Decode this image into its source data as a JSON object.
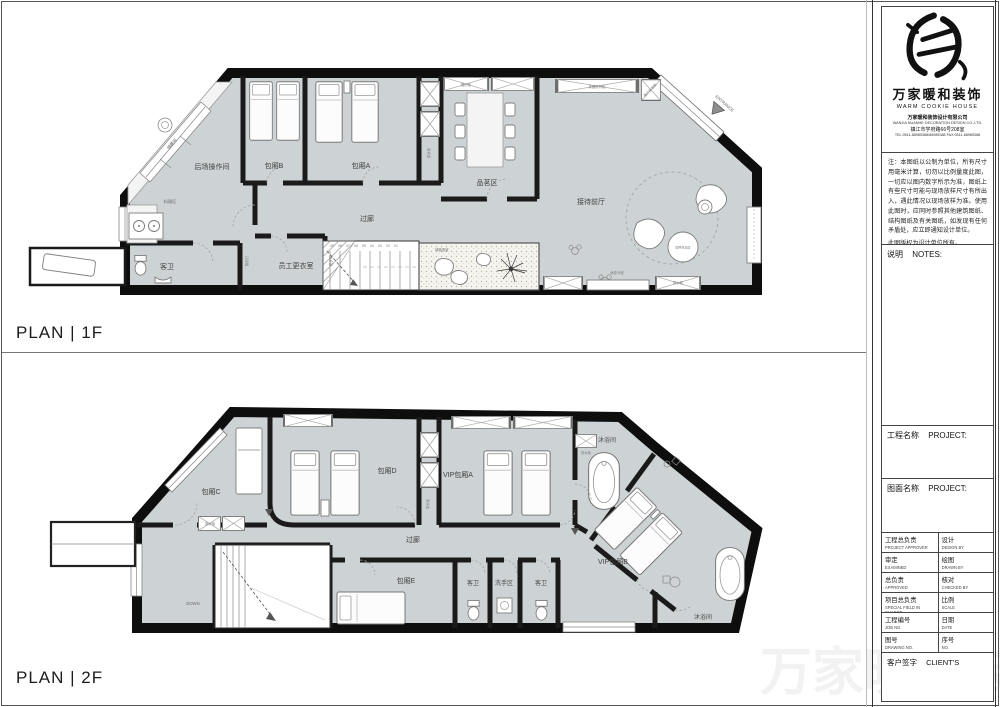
{
  "sheet": {
    "plan1_caption": "PLAN | 1F",
    "plan2_caption": "PLAN | 2F",
    "watermark": "万家暖和装饰"
  },
  "plan1f": {
    "rooms": {
      "kitchen": "后场操作间",
      "roomB": "包厢B",
      "roomA": "包厢A",
      "tea": "品茗区",
      "reception": "接待前厅",
      "corridor": "过廊",
      "cooking": "料理区",
      "toilet": "客卫",
      "staff": "员工更衣室"
    },
    "ann": {
      "entrance": "ENTRANCE",
      "storage": "储藏间",
      "hiddenDoor": "隐形门",
      "locker": "更衣柜",
      "teaCab": "茶水柜",
      "display": "展示柜",
      "shelf": "茶器陈列柜",
      "clientTea": "客户存茶柜",
      "garden": "绿植造景",
      "bench": "休息卡座",
      "stool": "圆凳休息区"
    },
    "stairs": [
      "09",
      "08",
      "07",
      "06",
      "05",
      "04",
      "03",
      "02",
      "01"
    ]
  },
  "plan2f": {
    "rooms": {
      "roomC": "包厢C",
      "roomD": "包厢D",
      "vipA": "VIP包厢A",
      "vipB": "VIP包厢B",
      "roomE": "包厢E",
      "showerTop": "沐浴间",
      "showerBottom": "沐浴间",
      "toilet1": "客卫",
      "wash": "洗手区",
      "toilet2": "客卫",
      "corridor": "过廊"
    },
    "ann": {
      "down": "DOWN",
      "teaCab": "茶水柜"
    }
  },
  "titleblock": {
    "brand": {
      "cn": "万家暖和装饰",
      "en": "WARM COOKIE HOUSE",
      "company_cn": "万家暖和装饰设计有限公司",
      "company_en": "WANJIA NUANHE DECORATION DESIGN CO.,LTD.",
      "address": "镇江市学府路66号208室",
      "phone": "TEL:0511-88985388/88985388  FAX:0511-88985388"
    },
    "disclaimer": "注：本图纸以公制为单位，所有尺寸用毫米计算，切勿以比例量度此图，一切应以图内数字所示为准，图纸上有些尺寸可能与现场放样尺寸有所出入，遇此情况以现场放样为准。使用此图时，应同时参照其他建筑图纸、结构图纸及有关图纸，如发现有任何矛盾处，应立即通知设计单位。",
    "copyright": "此图版权为设计单位所有。",
    "notes": {
      "cn": "说明",
      "en": "NOTES:"
    },
    "project": {
      "cn": "工程名称",
      "en": "PROJECT:"
    },
    "drawing": {
      "cn": "图面名称",
      "en": "PROJECT:"
    },
    "fields": [
      {
        "cn": "工程总负责",
        "en": "PROJECT APPROVER",
        "cn2": "设计",
        "en2": "DESIGN BY"
      },
      {
        "cn": "审定",
        "en": "EXAMINED",
        "cn2": "绘图",
        "en2": "DRAWN BY"
      },
      {
        "cn": "总负责",
        "en": "APPROVED",
        "cn2": "核对",
        "en2": "CHECKED BY"
      },
      {
        "cn": "项目总负责",
        "en": "SPECIAL FIELD IN CHARGE",
        "cn2": "比例",
        "en2": "SCALE"
      },
      {
        "cn": "工程编号",
        "en": "JOB NO.",
        "cn2": "日期",
        "en2": "DATE"
      },
      {
        "cn": "图号",
        "en": "DRAWING NO.",
        "cn2": "序号",
        "en2": "NO."
      }
    ],
    "client": {
      "cn": "客户签字",
      "en": "CLIENT'S"
    }
  }
}
